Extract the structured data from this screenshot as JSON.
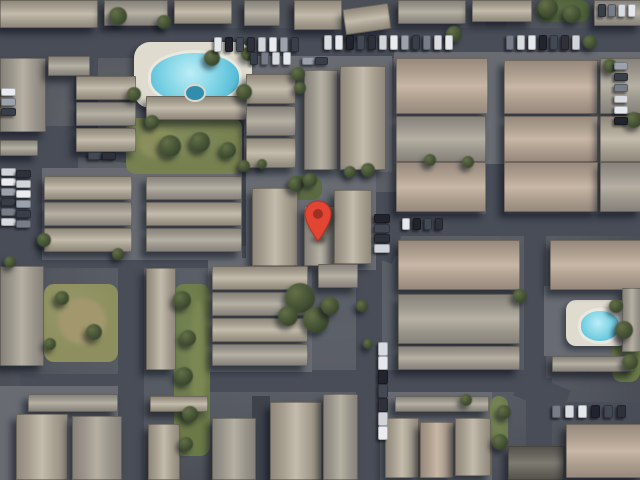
{
  "meta": {
    "app": "satellite-map-view",
    "view_type": "satellite imagery",
    "description": "Aerial satellite view of a residential condominium complex with a red location marker",
    "canvas": {
      "width": 640,
      "height": 480
    }
  },
  "marker": {
    "x": 318,
    "y": 242,
    "w": 30,
    "h": 42,
    "body_color": "#E74430",
    "inner_color": "#A33024",
    "stroke_color": "#B93322"
  },
  "palette": {
    "asphalt": "#494e59",
    "alley": "#3e434d",
    "ground_pad": "#686c73",
    "pool_water": "#7fd4e6",
    "pool_deck": "#ddd9cd",
    "lawn": "#76814e",
    "tree": "#4a573a",
    "roof_shades": [
      {
        "edge": "#8f887a",
        "mid": "#aaa293",
        "light": "#c2baa9"
      },
      {
        "edge": "#86817a",
        "mid": "#9e998e",
        "light": "#b4afa2"
      },
      {
        "edge": "#97897c",
        "mid": "#b0a090",
        "light": "#c7b6a4"
      },
      {
        "edge": "#57544e",
        "mid": "#6b6860",
        "light": "#7d7a70"
      }
    ],
    "car_colors": [
      "#e3e6ea",
      "#2f333c",
      "#9ba1ab",
      "#d6d9de",
      "#434a57",
      "#e8eaee",
      "#767d88",
      "#23262e",
      "#cfd3d9",
      "#3a404b"
    ]
  },
  "scene": {
    "roads": [
      {
        "x": 0,
        "y": 28,
        "w": 640,
        "h": 30
      },
      {
        "x": 0,
        "y": 126,
        "w": 78,
        "h": 126
      },
      {
        "x": 28,
        "y": 142,
        "w": 215,
        "h": 22,
        "rot": 7
      },
      {
        "x": 74,
        "y": 54,
        "w": 24,
        "h": 78
      },
      {
        "x": 236,
        "y": 58,
        "w": 16,
        "h": 212,
        "alley": true
      },
      {
        "x": 0,
        "y": 246,
        "w": 380,
        "h": 22
      },
      {
        "x": 378,
        "y": 214,
        "w": 262,
        "h": 22
      },
      {
        "x": 356,
        "y": 226,
        "w": 42,
        "h": 32,
        "rot": 18
      },
      {
        "x": 366,
        "y": 192,
        "w": 32,
        "h": 64
      },
      {
        "x": 356,
        "y": 236,
        "w": 26,
        "h": 244
      },
      {
        "x": 524,
        "y": 222,
        "w": 22,
        "h": 162
      },
      {
        "x": 526,
        "y": 378,
        "w": 26,
        "h": 102
      },
      {
        "x": 486,
        "y": 0,
        "w": 20,
        "h": 216
      },
      {
        "x": 588,
        "y": 0,
        "w": 52,
        "h": 32
      },
      {
        "x": 210,
        "y": 370,
        "w": 332,
        "h": 22
      },
      {
        "x": 548,
        "y": 402,
        "w": 92,
        "h": 18
      },
      {
        "x": 516,
        "y": 380,
        "w": 52,
        "h": 26,
        "rot": 22
      },
      {
        "x": 118,
        "y": 264,
        "w": 26,
        "h": 216
      },
      {
        "x": 20,
        "y": 374,
        "w": 102,
        "h": 18
      },
      {
        "x": 252,
        "y": 396,
        "w": 18,
        "h": 84,
        "alley": true
      },
      {
        "x": 296,
        "y": 148,
        "w": 84,
        "h": 18
      }
    ],
    "pads": [
      {
        "x": 42,
        "y": 168,
        "w": 200,
        "h": 92
      },
      {
        "x": 244,
        "y": 56,
        "w": 148,
        "h": 116
      },
      {
        "x": 394,
        "y": 52,
        "w": 246,
        "h": 112
      },
      {
        "x": 0,
        "y": 386,
        "w": 118,
        "h": 94
      },
      {
        "x": 380,
        "y": 392,
        "w": 112,
        "h": 88
      },
      {
        "x": 208,
        "y": 258,
        "w": 104,
        "h": 114
      },
      {
        "x": 544,
        "y": 286,
        "w": 96,
        "h": 70
      },
      {
        "x": 246,
        "y": 170,
        "w": 130,
        "h": 100
      }
    ],
    "greens": [
      {
        "x": 126,
        "y": 118,
        "w": 116,
        "h": 56,
        "c": "#76814e"
      },
      {
        "x": 44,
        "y": 284,
        "w": 74,
        "h": 78,
        "c": "#8d8f5c"
      },
      {
        "x": 174,
        "y": 284,
        "w": 36,
        "h": 172,
        "c": "#6a7a46"
      },
      {
        "x": 416,
        "y": 64,
        "w": 32,
        "h": 48,
        "c": "#5e7040"
      },
      {
        "x": 526,
        "y": 66,
        "w": 36,
        "h": 46,
        "c": "#5e7040"
      },
      {
        "x": 536,
        "y": 0,
        "w": 54,
        "h": 22,
        "c": "#4f6238"
      },
      {
        "x": 612,
        "y": 308,
        "w": 28,
        "h": 74,
        "c": "#6a7a46"
      },
      {
        "x": 288,
        "y": 176,
        "w": 34,
        "h": 24,
        "c": "#5b6b41"
      },
      {
        "x": 490,
        "y": 396,
        "w": 18,
        "h": 50,
        "c": "#6d7c4b"
      },
      {
        "x": 148,
        "y": 108,
        "w": 20,
        "h": 14,
        "c": "#76814e"
      }
    ],
    "patches": [
      {
        "x": 58,
        "y": 298,
        "w": 48,
        "h": 46,
        "c": "#a3976b"
      },
      {
        "x": 138,
        "y": 128,
        "w": 40,
        "h": 30,
        "c": "#8a8f5a"
      },
      {
        "x": 190,
        "y": 300,
        "w": 16,
        "h": 120,
        "c": "#7c8851"
      }
    ],
    "buildings": [
      {
        "x": 0,
        "y": 0,
        "w": 96,
        "h": 26,
        "o": "h",
        "s": 0
      },
      {
        "x": 104,
        "y": 0,
        "w": 62,
        "h": 24,
        "o": "h",
        "s": 1
      },
      {
        "x": 174,
        "y": 0,
        "w": 56,
        "h": 22,
        "o": "h",
        "s": 0
      },
      {
        "x": 244,
        "y": 0,
        "w": 34,
        "h": 24,
        "o": "h",
        "s": 1
      },
      {
        "x": 294,
        "y": 0,
        "w": 46,
        "h": 28,
        "o": "h",
        "s": 0
      },
      {
        "x": 344,
        "y": 6,
        "w": 44,
        "h": 24,
        "o": "h",
        "s": 0,
        "rot": -8
      },
      {
        "x": 398,
        "y": 0,
        "w": 66,
        "h": 22,
        "o": "h",
        "s": 1
      },
      {
        "x": 472,
        "y": 0,
        "w": 58,
        "h": 20,
        "o": "h",
        "s": 0
      },
      {
        "x": 594,
        "y": 0,
        "w": 46,
        "h": 24,
        "o": "h",
        "s": 1
      },
      {
        "x": 0,
        "y": 58,
        "w": 44,
        "h": 72,
        "o": "v",
        "s": 1
      },
      {
        "x": 48,
        "y": 56,
        "w": 40,
        "h": 18,
        "o": "h",
        "s": 1
      },
      {
        "x": 76,
        "y": 76,
        "w": 58,
        "h": 22,
        "o": "h",
        "s": 0
      },
      {
        "x": 76,
        "y": 102,
        "w": 58,
        "h": 22,
        "o": "h",
        "s": 1
      },
      {
        "x": 76,
        "y": 128,
        "w": 58,
        "h": 22,
        "o": "h",
        "s": 0
      },
      {
        "x": 0,
        "y": 140,
        "w": 36,
        "h": 14,
        "o": "h",
        "s": 1
      },
      {
        "x": 146,
        "y": 96,
        "w": 100,
        "h": 22,
        "o": "h",
        "s": 0
      },
      {
        "x": 246,
        "y": 74,
        "w": 48,
        "h": 28,
        "o": "h",
        "s": 0
      },
      {
        "x": 246,
        "y": 106,
        "w": 48,
        "h": 28,
        "o": "h",
        "s": 1
      },
      {
        "x": 246,
        "y": 138,
        "w": 48,
        "h": 28,
        "o": "h",
        "s": 0
      },
      {
        "x": 304,
        "y": 70,
        "w": 32,
        "h": 98,
        "o": "v",
        "s": 1
      },
      {
        "x": 340,
        "y": 66,
        "w": 44,
        "h": 102,
        "o": "v",
        "s": 0
      },
      {
        "x": 396,
        "y": 58,
        "w": 90,
        "h": 54,
        "o": "h",
        "s": 2
      },
      {
        "x": 504,
        "y": 60,
        "w": 92,
        "h": 52,
        "o": "h",
        "s": 2
      },
      {
        "x": 600,
        "y": 58,
        "w": 40,
        "h": 54,
        "o": "h",
        "s": 1
      },
      {
        "x": 396,
        "y": 116,
        "w": 88,
        "h": 44,
        "o": "h",
        "s": 1
      },
      {
        "x": 504,
        "y": 116,
        "w": 92,
        "h": 44,
        "o": "h",
        "s": 2
      },
      {
        "x": 600,
        "y": 116,
        "w": 40,
        "h": 44,
        "o": "h",
        "s": 0
      },
      {
        "x": 396,
        "y": 162,
        "w": 88,
        "h": 48,
        "o": "h",
        "s": 2
      },
      {
        "x": 504,
        "y": 162,
        "w": 92,
        "h": 48,
        "o": "h",
        "s": 2
      },
      {
        "x": 600,
        "y": 162,
        "w": 40,
        "h": 48,
        "o": "h",
        "s": 1
      },
      {
        "x": 44,
        "y": 176,
        "w": 86,
        "h": 22,
        "o": "h",
        "s": 0
      },
      {
        "x": 44,
        "y": 202,
        "w": 86,
        "h": 22,
        "o": "h",
        "s": 1
      },
      {
        "x": 44,
        "y": 228,
        "w": 86,
        "h": 22,
        "o": "h",
        "s": 0
      },
      {
        "x": 146,
        "y": 176,
        "w": 94,
        "h": 22,
        "o": "h",
        "s": 1
      },
      {
        "x": 146,
        "y": 202,
        "w": 94,
        "h": 22,
        "o": "h",
        "s": 0
      },
      {
        "x": 146,
        "y": 228,
        "w": 94,
        "h": 22,
        "o": "h",
        "s": 1
      },
      {
        "x": 252,
        "y": 188,
        "w": 44,
        "h": 76,
        "o": "v",
        "s": 0
      },
      {
        "x": 304,
        "y": 206,
        "w": 30,
        "h": 58,
        "o": "v",
        "s": 1
      },
      {
        "x": 334,
        "y": 190,
        "w": 36,
        "h": 72,
        "o": "v",
        "s": 0
      },
      {
        "x": 398,
        "y": 240,
        "w": 120,
        "h": 48,
        "o": "h",
        "s": 2
      },
      {
        "x": 550,
        "y": 240,
        "w": 90,
        "h": 48,
        "o": "h",
        "s": 2
      },
      {
        "x": 398,
        "y": 294,
        "w": 120,
        "h": 48,
        "o": "h",
        "s": 1
      },
      {
        "x": 622,
        "y": 288,
        "w": 18,
        "h": 62,
        "o": "v",
        "s": 1
      },
      {
        "x": 398,
        "y": 346,
        "w": 120,
        "h": 22,
        "o": "h",
        "s": 1
      },
      {
        "x": 552,
        "y": 356,
        "w": 80,
        "h": 14,
        "o": "h",
        "s": 1
      },
      {
        "x": 0,
        "y": 266,
        "w": 42,
        "h": 98,
        "o": "v",
        "s": 1
      },
      {
        "x": 146,
        "y": 268,
        "w": 28,
        "h": 100,
        "o": "v",
        "s": 0
      },
      {
        "x": 212,
        "y": 266,
        "w": 94,
        "h": 22,
        "o": "h",
        "s": 0
      },
      {
        "x": 212,
        "y": 292,
        "w": 94,
        "h": 22,
        "o": "h",
        "s": 1
      },
      {
        "x": 212,
        "y": 318,
        "w": 94,
        "h": 22,
        "o": "h",
        "s": 0
      },
      {
        "x": 212,
        "y": 344,
        "w": 94,
        "h": 20,
        "o": "h",
        "s": 1
      },
      {
        "x": 318,
        "y": 264,
        "w": 38,
        "h": 22,
        "o": "h",
        "s": 1
      },
      {
        "x": 28,
        "y": 394,
        "w": 88,
        "h": 16,
        "o": "h",
        "s": 1
      },
      {
        "x": 16,
        "y": 414,
        "w": 50,
        "h": 64,
        "o": "v",
        "s": 0
      },
      {
        "x": 72,
        "y": 416,
        "w": 48,
        "h": 62,
        "o": "v",
        "s": 1
      },
      {
        "x": 148,
        "y": 424,
        "w": 30,
        "h": 54,
        "o": "v",
        "s": 0
      },
      {
        "x": 150,
        "y": 396,
        "w": 56,
        "h": 14,
        "o": "h",
        "s": 0
      },
      {
        "x": 212,
        "y": 418,
        "w": 42,
        "h": 60,
        "o": "v",
        "s": 1
      },
      {
        "x": 270,
        "y": 402,
        "w": 50,
        "h": 76,
        "o": "v",
        "s": 0
      },
      {
        "x": 323,
        "y": 394,
        "w": 33,
        "h": 84,
        "o": "v",
        "s": 1
      },
      {
        "x": 395,
        "y": 396,
        "w": 92,
        "h": 14,
        "o": "h",
        "s": 1
      },
      {
        "x": 385,
        "y": 418,
        "w": 32,
        "h": 58,
        "o": "v",
        "s": 0
      },
      {
        "x": 420,
        "y": 422,
        "w": 32,
        "h": 54,
        "o": "v",
        "s": 2
      },
      {
        "x": 455,
        "y": 418,
        "w": 34,
        "h": 56,
        "o": "v",
        "s": 0
      },
      {
        "x": 508,
        "y": 446,
        "w": 54,
        "h": 32,
        "o": "h",
        "s": 3
      },
      {
        "x": 566,
        "y": 424,
        "w": 74,
        "h": 52,
        "o": "h",
        "s": 2
      }
    ],
    "pools": [
      {
        "deck": {
          "x": 134,
          "y": 42,
          "w": 118,
          "h": 66,
          "r": 16
        },
        "water": {
          "x": 148,
          "y": 50,
          "w": 88,
          "h": 50
        },
        "spa": {
          "x": 184,
          "y": 84,
          "w": 18,
          "h": 14
        }
      },
      {
        "deck": {
          "x": 566,
          "y": 300,
          "w": 62,
          "h": 46,
          "r": 10
        },
        "water": {
          "x": 578,
          "y": 308,
          "w": 38,
          "h": 30
        }
      }
    ],
    "trees": [
      [
        118,
        16,
        9
      ],
      [
        164,
        22,
        7
      ],
      [
        212,
        58,
        8
      ],
      [
        248,
        54,
        7
      ],
      [
        134,
        94,
        7
      ],
      [
        244,
        92,
        8
      ],
      [
        170,
        146,
        11
      ],
      [
        200,
        142,
        10
      ],
      [
        228,
        150,
        8
      ],
      [
        152,
        122,
        7
      ],
      [
        298,
        74,
        7
      ],
      [
        300,
        88,
        6
      ],
      [
        368,
        170,
        7
      ],
      [
        350,
        172,
        6
      ],
      [
        454,
        34,
        8
      ],
      [
        548,
        8,
        10
      ],
      [
        572,
        14,
        9
      ],
      [
        590,
        42,
        7
      ],
      [
        610,
        66,
        7
      ],
      [
        634,
        120,
        8
      ],
      [
        296,
        184,
        8
      ],
      [
        310,
        180,
        7
      ],
      [
        300,
        298,
        15
      ],
      [
        316,
        320,
        13
      ],
      [
        288,
        316,
        10
      ],
      [
        330,
        306,
        9
      ],
      [
        182,
        300,
        9
      ],
      [
        188,
        338,
        8
      ],
      [
        184,
        376,
        9
      ],
      [
        190,
        414,
        8
      ],
      [
        186,
        444,
        7
      ],
      [
        62,
        298,
        7
      ],
      [
        94,
        332,
        8
      ],
      [
        50,
        344,
        6
      ],
      [
        520,
        296,
        7
      ],
      [
        624,
        330,
        9
      ],
      [
        630,
        362,
        8
      ],
      [
        616,
        306,
        7
      ],
      [
        504,
        412,
        7
      ],
      [
        500,
        442,
        8
      ],
      [
        466,
        400,
        6
      ],
      [
        44,
        240,
        7
      ],
      [
        10,
        262,
        6
      ],
      [
        118,
        254,
        6
      ],
      [
        362,
        306,
        6
      ],
      [
        368,
        344,
        5
      ],
      [
        244,
        166,
        6
      ],
      [
        262,
        164,
        5
      ],
      [
        430,
        160,
        6
      ],
      [
        468,
        162,
        6
      ]
    ],
    "parking_rows": [
      {
        "x": 214,
        "y": 37,
        "count": 8,
        "dx": 11,
        "dy": 0,
        "w": 6,
        "h": 13
      },
      {
        "x": 324,
        "y": 35,
        "count": 12,
        "dx": 11,
        "dy": 0,
        "w": 6,
        "h": 13
      },
      {
        "x": 506,
        "y": 35,
        "count": 7,
        "dx": 11,
        "dy": 0,
        "w": 6,
        "h": 13
      },
      {
        "x": 598,
        "y": 4,
        "count": 4,
        "dx": 10,
        "dy": 0,
        "w": 6,
        "h": 11
      },
      {
        "x": 614,
        "y": 62,
        "count": 6,
        "dx": 0,
        "dy": 11,
        "w": 12,
        "h": 6
      },
      {
        "x": 1,
        "y": 88,
        "count": 3,
        "dx": 0,
        "dy": 10,
        "w": 13,
        "h": 6
      },
      {
        "x": 1,
        "y": 168,
        "count": 6,
        "dx": 0,
        "dy": 10,
        "w": 13,
        "h": 6
      },
      {
        "x": 16,
        "y": 170,
        "count": 6,
        "dx": 0,
        "dy": 10,
        "w": 13,
        "h": 6
      },
      {
        "x": 88,
        "y": 152,
        "count": 2,
        "dx": 14,
        "dy": 0,
        "w": 12,
        "h": 6
      },
      {
        "x": 374,
        "y": 214,
        "count": 4,
        "dx": 0,
        "dy": 10,
        "w": 14,
        "h": 7
      },
      {
        "x": 402,
        "y": 218,
        "count": 4,
        "dx": 11,
        "dy": 0,
        "w": 6,
        "h": 10
      },
      {
        "x": 378,
        "y": 342,
        "count": 7,
        "dx": 0,
        "dy": 14,
        "w": 8,
        "h": 12
      },
      {
        "x": 552,
        "y": 405,
        "count": 6,
        "dx": 13,
        "dy": 0,
        "w": 7,
        "h": 11
      },
      {
        "x": 250,
        "y": 52,
        "count": 4,
        "dx": 11,
        "dy": 0,
        "w": 6,
        "h": 11
      },
      {
        "x": 302,
        "y": 57,
        "count": 2,
        "dx": 13,
        "dy": 0,
        "w": 11,
        "h": 6
      }
    ]
  }
}
